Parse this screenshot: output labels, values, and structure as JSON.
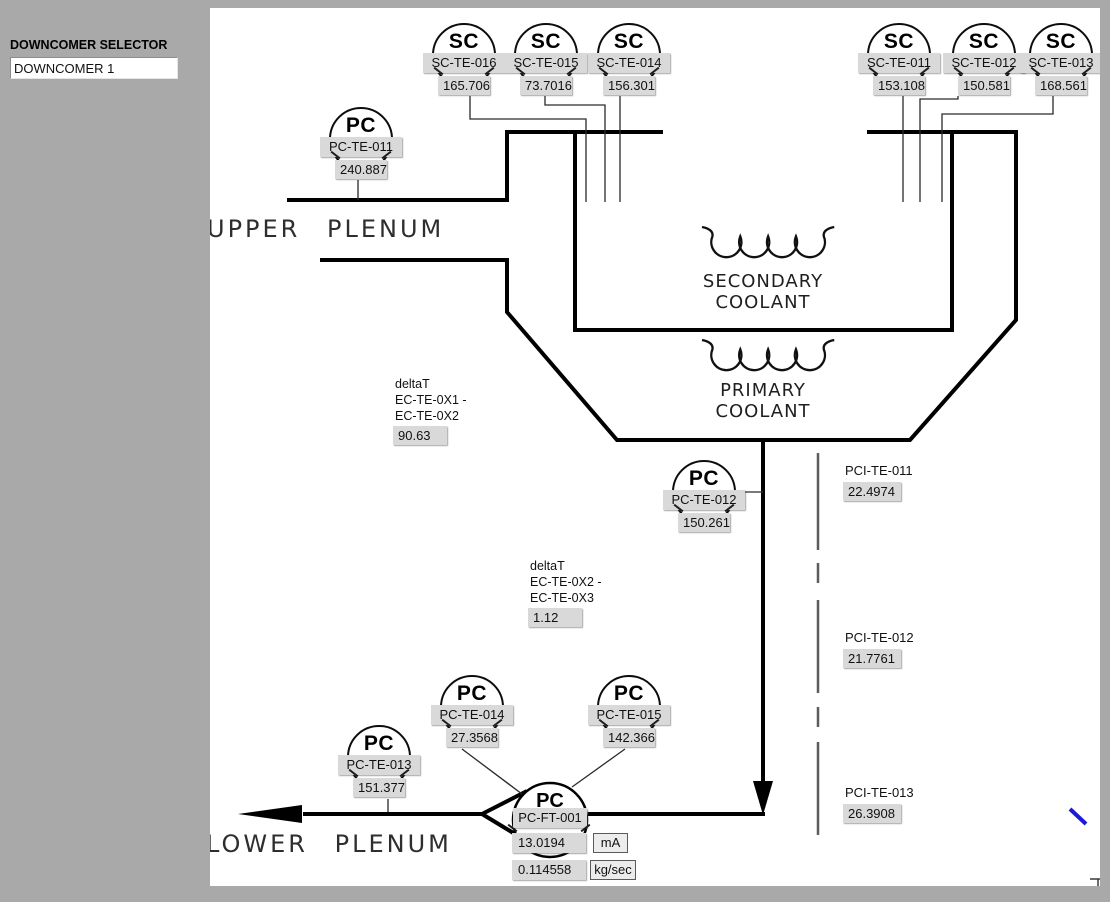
{
  "selector": {
    "label": "DOWNCOMER SELECTOR",
    "value": "DOWNCOMER 1"
  },
  "instruments": [
    {
      "type": "SC",
      "tag": "SC-TE-016",
      "value": "165.706"
    },
    {
      "type": "SC",
      "tag": "SC-TE-015",
      "value": "73.7016"
    },
    {
      "type": "SC",
      "tag": "SC-TE-014",
      "value": "156.301"
    },
    {
      "type": "SC",
      "tag": "SC-TE-011",
      "value": "153.108"
    },
    {
      "type": "SC",
      "tag": "SC-TE-012",
      "value": "150.581"
    },
    {
      "type": "SC",
      "tag": "SC-TE-013",
      "value": "168.561"
    },
    {
      "type": "PC",
      "tag": "PC-TE-011",
      "value": "240.887"
    },
    {
      "type": "PC",
      "tag": "PC-TE-012",
      "value": "150.261"
    },
    {
      "type": "PC",
      "tag": "PC-TE-014",
      "value": "27.3568"
    },
    {
      "type": "PC",
      "tag": "PC-TE-015",
      "value": "142.366"
    },
    {
      "type": "PC",
      "tag": "PC-TE-013",
      "value": "151.377"
    }
  ],
  "flow_transmitter": {
    "type": "PC",
    "tag": "PC-FT-001",
    "current": "13.0194",
    "current_unit": "mA",
    "flow": "0.114558",
    "flow_unit": "kg/sec"
  },
  "pci_indicators": [
    {
      "label": "PCI-TE-011",
      "value": "22.4974"
    },
    {
      "label": "PCI-TE-012",
      "value": "21.7761"
    },
    {
      "label": "PCI-TE-013",
      "value": "26.3908"
    }
  ],
  "delta_t": [
    {
      "line1": "deltaT",
      "line2": "EC-TE-0X1 -",
      "line3": "EC-TE-0X2",
      "value": "90.63"
    },
    {
      "line1": "deltaT",
      "line2": "EC-TE-0X2 -",
      "line3": "EC-TE-0X3",
      "value": "1.12"
    }
  ],
  "diagram_labels": {
    "upper_plenum": "UPPER PLENUM",
    "lower_plenum": "LOWER PLENUM",
    "secondary_line1": "SECONDARY",
    "secondary_line2": "COOLANT",
    "primary_line1": "PRIMARY",
    "primary_line2": "COOLANT"
  },
  "colors": {
    "page_bg": "#a9a9a9",
    "canvas_bg": "#ffffff",
    "line": "#000000",
    "box_bg": "#d9d9d9",
    "annotation_blue": "#1a1ad8"
  }
}
